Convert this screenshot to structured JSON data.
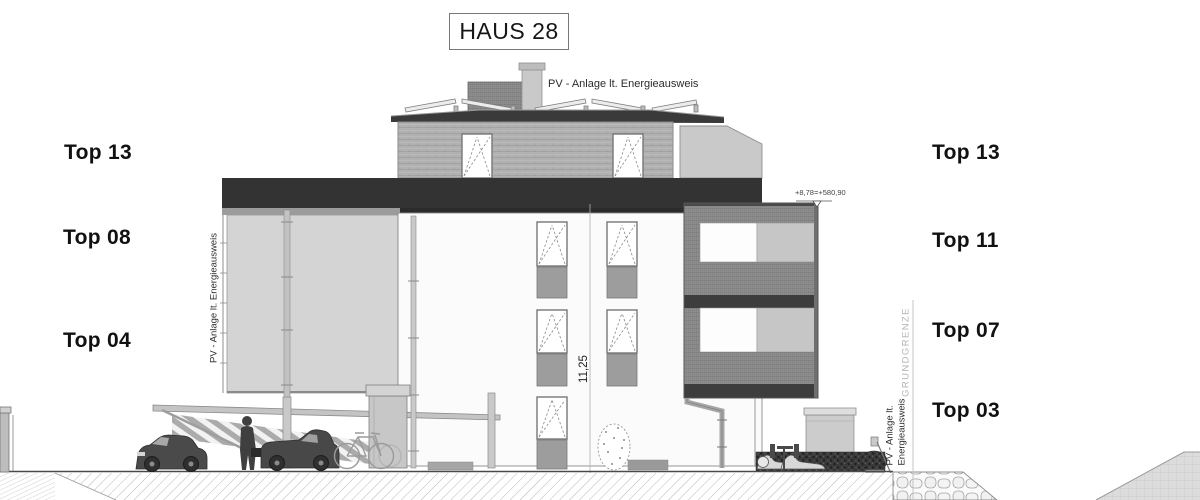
{
  "title": "HAUS 28",
  "unit_labels": {
    "left": [
      {
        "text": "Top 13"
      },
      {
        "text": "Top 08"
      },
      {
        "text": "Top 04"
      }
    ],
    "right": [
      {
        "text": "Top 13"
      },
      {
        "text": "Top 11"
      },
      {
        "text": "Top 07"
      },
      {
        "text": "Top 03"
      }
    ]
  },
  "annotations": {
    "pv_roof": "PV - Anlage lt. Energieausweis",
    "pv_left_wall": "PV - Anlage lt. Energieausweis",
    "pv_right_line1": "PV - Anlage lt.",
    "pv_right_line2": "Energieausweis",
    "property_boundary": "GRUNDGRENZE",
    "height_dimension": "11,25",
    "level_mark": "+8,78=+580,90"
  },
  "colors": {
    "parapet_dark": "#333333",
    "slab_dark": "#3d3d3d",
    "facade_white": "#fbfbfb",
    "pv_panel_wall": "#d4d4d4",
    "balcony_mesh": "#8e8e8e",
    "window_panel": "#9d9d9d",
    "line_gray": "#888888"
  }
}
